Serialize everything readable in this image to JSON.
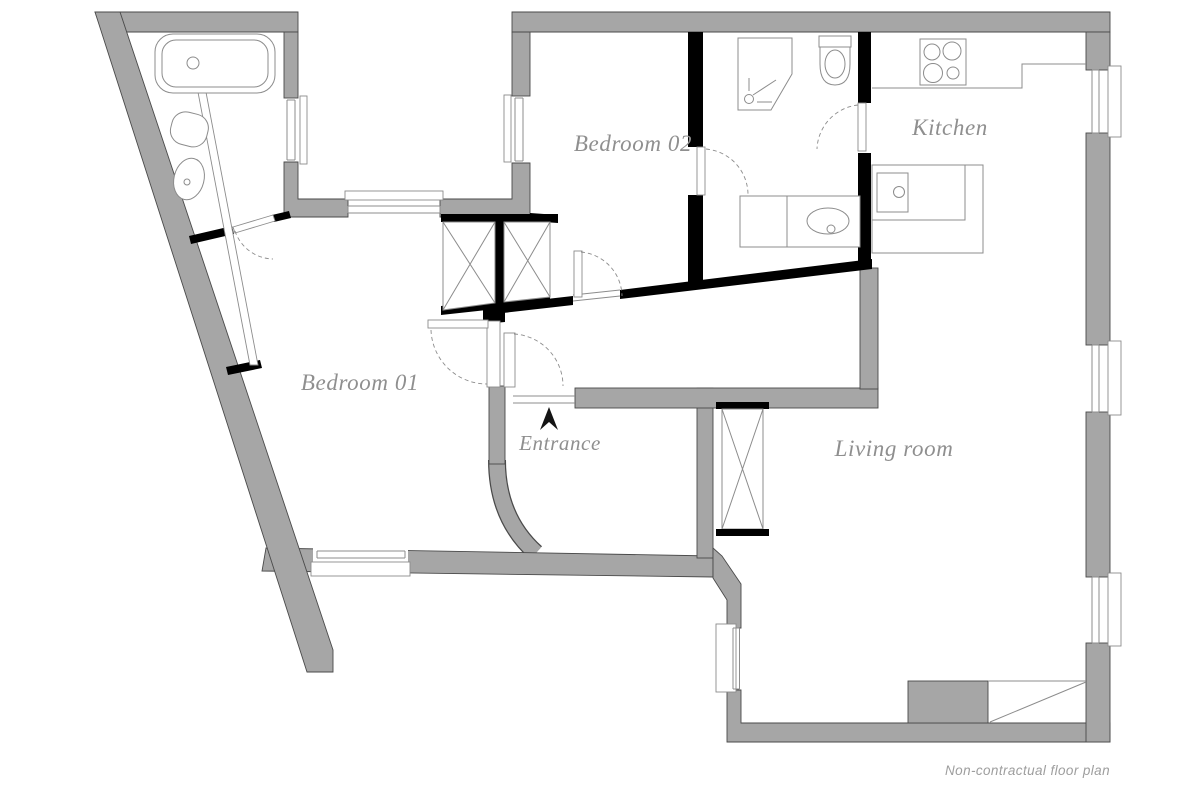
{
  "plan": {
    "rooms": [
      {
        "id": "bedroom-01",
        "label": "Bedroom 01"
      },
      {
        "id": "bedroom-02",
        "label": "Bedroom 02"
      },
      {
        "id": "kitchen",
        "label": "Kitchen"
      },
      {
        "id": "living-room",
        "label": "Living room"
      },
      {
        "id": "entrance",
        "label": "Entrance"
      }
    ],
    "footer_note": "Non-contractual floor plan",
    "icons": {
      "entrance_arrow": "north-pointing solid arrow",
      "fixtures": [
        "bathtub",
        "toilet",
        "washbasin",
        "shower",
        "vanity-sink",
        "stove",
        "kitchen-island-sink",
        "duct-x-box",
        "wardrobe-partition"
      ]
    },
    "colors": {
      "bg": "#ffffff",
      "wall_gray": "#a6a6a6",
      "wall_edge": "#4a4a4a",
      "black": "#000000",
      "line": "#8c8c8c",
      "label": "#8f8f8f",
      "footer": "#9e9e9e"
    }
  }
}
